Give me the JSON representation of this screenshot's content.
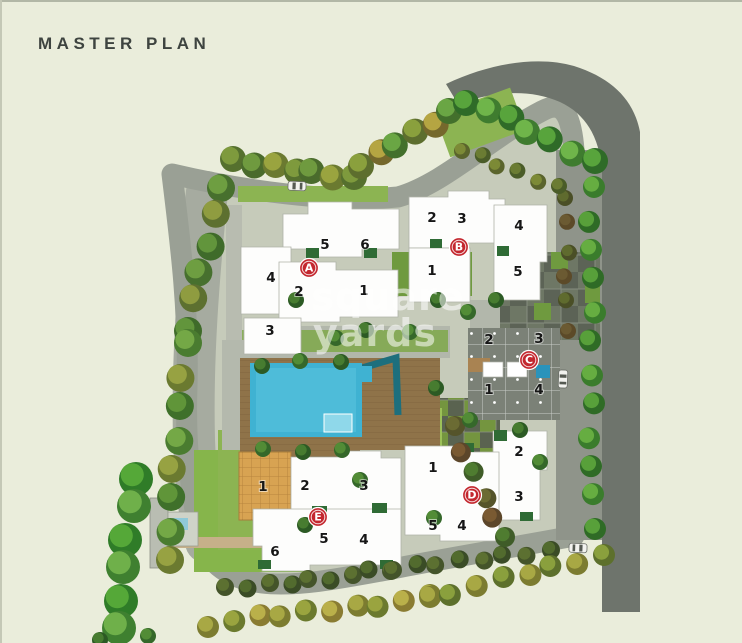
{
  "header": {
    "title": "MASTER PLAN"
  },
  "watermark": {
    "line1": "square",
    "line2": "yards"
  },
  "colors": {
    "background": "#eaeddb",
    "title_text": "#3e4440",
    "ring_road": "#9aa095",
    "outer_road_dark": "#6e746c",
    "inner_road": "#8f948a",
    "building": "#fdfdfc",
    "pool": "#3fb2d2",
    "pool_light": "#8fd8ea",
    "deck": "#8f7349",
    "clubhouse": "#d8a352",
    "lawn": "#8cb452",
    "tower_marker": "#c3272e",
    "unit_number": "#161616",
    "watermark_text": "#ffffff"
  },
  "plan": {
    "towers": [
      {
        "id": "A",
        "marker": {
          "x": 309,
          "y": 268
        },
        "units": [
          {
            "n": "5",
            "x": 325,
            "y": 245
          },
          {
            "n": "6",
            "x": 365,
            "y": 245
          },
          {
            "n": "4",
            "x": 271,
            "y": 278
          },
          {
            "n": "2",
            "x": 299,
            "y": 292
          },
          {
            "n": "1",
            "x": 364,
            "y": 291
          },
          {
            "n": "3",
            "x": 270,
            "y": 331
          }
        ]
      },
      {
        "id": "B",
        "marker": {
          "x": 459,
          "y": 247
        },
        "units": [
          {
            "n": "2",
            "x": 432,
            "y": 218
          },
          {
            "n": "3",
            "x": 462,
            "y": 219
          },
          {
            "n": "4",
            "x": 519,
            "y": 226
          },
          {
            "n": "1",
            "x": 432,
            "y": 271
          },
          {
            "n": "5",
            "x": 518,
            "y": 272
          }
        ]
      },
      {
        "id": "C",
        "marker": {
          "x": 529,
          "y": 360
        },
        "units": [
          {
            "n": "2",
            "x": 489,
            "y": 340
          },
          {
            "n": "3",
            "x": 539,
            "y": 339
          },
          {
            "n": "1",
            "x": 489,
            "y": 390
          },
          {
            "n": "4",
            "x": 539,
            "y": 390
          }
        ]
      },
      {
        "id": "D",
        "marker": {
          "x": 472,
          "y": 495
        },
        "units": [
          {
            "n": "2",
            "x": 519,
            "y": 452
          },
          {
            "n": "1",
            "x": 433,
            "y": 468
          },
          {
            "n": "3",
            "x": 519,
            "y": 497
          },
          {
            "n": "5",
            "x": 433,
            "y": 526
          },
          {
            "n": "4",
            "x": 462,
            "y": 526
          }
        ]
      },
      {
        "id": "E",
        "marker": {
          "x": 318,
          "y": 517
        },
        "units": [
          {
            "n": "1",
            "x": 263,
            "y": 487
          },
          {
            "n": "2",
            "x": 305,
            "y": 486
          },
          {
            "n": "3",
            "x": 364,
            "y": 486
          },
          {
            "n": "5",
            "x": 324,
            "y": 539
          },
          {
            "n": "4",
            "x": 364,
            "y": 540
          },
          {
            "n": "6",
            "x": 275,
            "y": 552
          }
        ]
      }
    ],
    "cars": [
      {
        "x": 297,
        "y": 186,
        "rot": 2
      },
      {
        "x": 563,
        "y": 379,
        "rot": 92
      },
      {
        "x": 578,
        "y": 548,
        "rot": 182
      }
    ],
    "scenery": {
      "tree_rows": [
        {
          "x1": 236,
          "y1": 162,
          "x2": 352,
          "y2": 177,
          "n": 7,
          "r": 13,
          "palette": [
            [
              "#55702e",
              "#7e9a3d"
            ],
            [
              "#4a6b2c",
              "#6f9a3f"
            ],
            [
              "#6b7a30",
              "#9aa43f"
            ]
          ]
        },
        {
          "x1": 360,
          "y1": 166,
          "x2": 452,
          "y2": 112,
          "n": 6,
          "r": 13,
          "palette": [
            [
              "#5d6e2e",
              "#8aa03d"
            ],
            [
              "#75682c",
              "#b5a542"
            ],
            [
              "#43702c",
              "#6aa644"
            ]
          ]
        },
        {
          "x1": 468,
          "y1": 100,
          "x2": 592,
          "y2": 162,
          "n": 7,
          "r": 13,
          "palette": [
            [
              "#2f6b28",
              "#58a43c"
            ],
            [
              "#3f7c2f",
              "#6fb54a"
            ]
          ]
        },
        {
          "x1": 592,
          "y1": 188,
          "x2": 592,
          "y2": 528,
          "n": 12,
          "r": 11,
          "palette": [
            [
              "#3a7c2c",
              "#66ad41"
            ],
            [
              "#2f6b26",
              "#58a03a"
            ]
          ]
        },
        {
          "x1": 222,
          "y1": 186,
          "x2": 186,
          "y2": 330,
          "n": 6,
          "r": 14,
          "palette": [
            [
              "#47702e",
              "#6e9e41"
            ],
            [
              "#5d7030",
              "#8f9c40"
            ],
            [
              "#3f6b2a",
              "#62953c"
            ]
          ]
        },
        {
          "x1": 185,
          "y1": 345,
          "x2": 167,
          "y2": 562,
          "n": 8,
          "r": 14,
          "palette": [
            [
              "#4a7c30",
              "#74a846"
            ],
            [
              "#6b7a30",
              "#97a242"
            ],
            [
              "#3f702a",
              "#609539"
            ]
          ]
        },
        {
          "x1": 136,
          "y1": 478,
          "x2": 116,
          "y2": 628,
          "n": 6,
          "r": 17,
          "palette": [
            [
              "#2f7c28",
              "#55a838"
            ],
            [
              "#3f8030",
              "#6fb04a"
            ]
          ]
        },
        {
          "x1": 228,
          "y1": 590,
          "x2": 392,
          "y2": 570,
          "n": 9,
          "r": 9,
          "palette": [
            [
              "#44542a",
              "#5c7031"
            ],
            [
              "#3a4c26",
              "#526b2e"
            ]
          ]
        },
        {
          "x1": 392,
          "y1": 570,
          "x2": 550,
          "y2": 550,
          "n": 8,
          "r": 9,
          "palette": [
            [
              "#44542a",
              "#5c7031"
            ],
            [
              "#3a4c26",
              "#526b2e"
            ]
          ]
        },
        {
          "x1": 210,
          "y1": 624,
          "x2": 428,
          "y2": 598,
          "n": 10,
          "r": 11,
          "palette": [
            [
              "#7c7c30",
              "#a8a844"
            ],
            [
              "#6b7a2e",
              "#9aa43f"
            ],
            [
              "#8a7c32",
              "#bab04a"
            ]
          ]
        },
        {
          "x1": 428,
          "y1": 598,
          "x2": 602,
          "y2": 556,
          "n": 8,
          "r": 11,
          "palette": [
            [
              "#7c7c30",
              "#a8a844"
            ],
            [
              "#5d702c",
              "#8aa03d"
            ]
          ]
        },
        {
          "x1": 566,
          "y1": 196,
          "x2": 566,
          "y2": 330,
          "n": 6,
          "r": 8,
          "palette": [
            [
              "#4a4f26",
              "#5f6b2e"
            ],
            [
              "#5c4a28",
              "#6b5a32"
            ]
          ]
        },
        {
          "x1": 452,
          "y1": 428,
          "x2": 506,
          "y2": 540,
          "n": 6,
          "r": 10,
          "palette": [
            [
              "#55542a",
              "#6b6b33"
            ],
            [
              "#5c462a",
              "#7a5a32"
            ],
            [
              "#3f5c28",
              "#4f7c30"
            ]
          ]
        },
        {
          "x1": 462,
          "y1": 150,
          "x2": 556,
          "y2": 186,
          "n": 6,
          "r": 8,
          "palette": [
            [
              "#5a642c",
              "#7c8a36"
            ],
            [
              "#4a5c28",
              "#6b7c33"
            ]
          ]
        }
      ],
      "scatter": {
        "r": 8,
        "palette": [
          [
            "#2c5a24",
            "#477c30"
          ],
          [
            "#35682a",
            "#528c36"
          ]
        ],
        "pts": [
          [
            262,
            366
          ],
          [
            300,
            361
          ],
          [
            341,
            362
          ],
          [
            263,
            449
          ],
          [
            303,
            452
          ],
          [
            342,
            450
          ],
          [
            296,
            300
          ],
          [
            336,
            338
          ],
          [
            366,
            330
          ],
          [
            410,
            332
          ],
          [
            438,
            300
          ],
          [
            468,
            312
          ],
          [
            436,
            388
          ],
          [
            470,
            420
          ],
          [
            496,
            300
          ],
          [
            540,
            462
          ],
          [
            305,
            525
          ],
          [
            434,
            518
          ],
          [
            520,
            430
          ],
          [
            360,
            480
          ],
          [
            100,
            640
          ],
          [
            148,
            636
          ]
        ]
      }
    }
  }
}
